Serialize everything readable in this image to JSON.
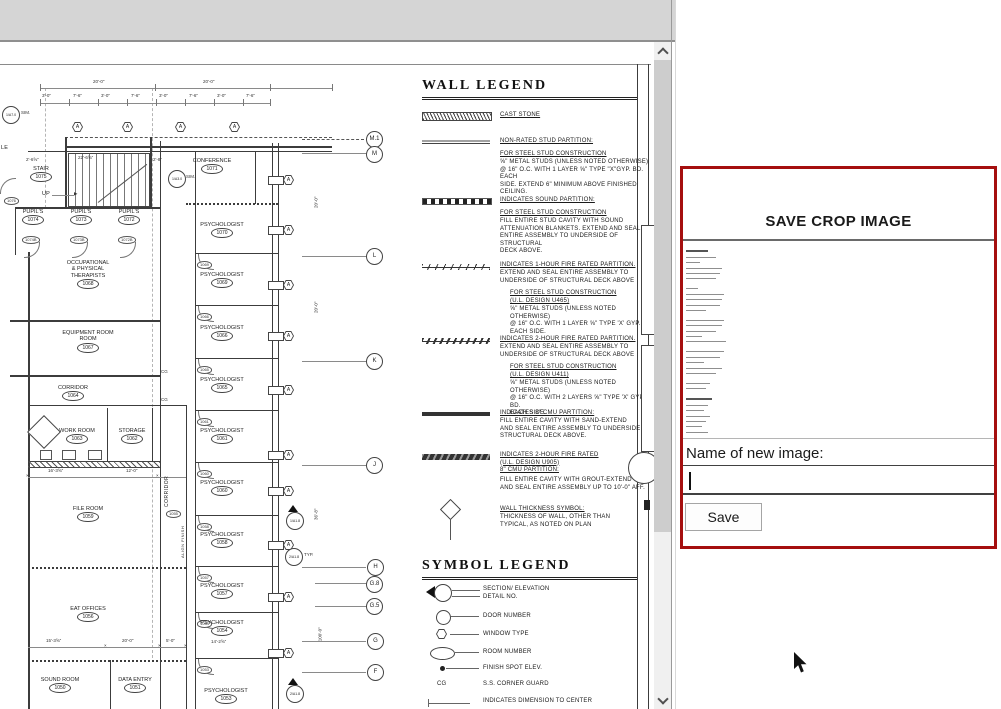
{
  "panel": {
    "title": "SAVE CROP IMAGE",
    "name_label": "Name of new image:",
    "input_value": "",
    "save_label": "Save"
  },
  "plan": {
    "window_tag": "A",
    "grid": [
      "M.1",
      "M",
      "L",
      "K",
      "J",
      "H",
      "G.8",
      "G.5",
      "G",
      "F"
    ],
    "rooms": [
      {
        "name": "STAIR",
        "num": "1075"
      },
      {
        "name": "CONFERENCE",
        "num": "1071"
      },
      {
        "name": "PUPIL'S",
        "num": "1074"
      },
      {
        "name": "PUPIL'S",
        "num": "1073"
      },
      {
        "name": "PUPIL'S",
        "num": "1072"
      },
      {
        "name": "PSYCHOLOGIST",
        "num": "1070"
      },
      {
        "name": "PSYCHOLOGIST",
        "num": "1069"
      },
      {
        "name": "OCCUPATIONAL\n& PHYSICAL\nTHERAPISTS",
        "num": "1068"
      },
      {
        "name": "EQUIPMENT ROOM\nROOM",
        "num": "1067"
      },
      {
        "name": "PSYCHOLOGIST",
        "num": "1066"
      },
      {
        "name": "CORRIDOR",
        "num": "1064"
      },
      {
        "name": "PSYCHOLOGIST",
        "num": "1065"
      },
      {
        "name": "WORK ROOM",
        "num": "1063"
      },
      {
        "name": "STORAGE",
        "num": "1062"
      },
      {
        "name": "PSYCHOLOGIST",
        "num": "1061"
      },
      {
        "name": "PSYCHOLOGIST",
        "num": "1060"
      },
      {
        "name": "FILE ROOM",
        "num": "1059"
      },
      {
        "name": "PSYCHOLOGIST",
        "num": "1058"
      },
      {
        "name": "PSYCHOLOGIST",
        "num": "1057"
      },
      {
        "name": "EAT OFFICES",
        "num": "1056"
      },
      {
        "name": "PSYCHOLOGIST",
        "num": "1054"
      },
      {
        "name": "SOUND ROOM",
        "num": "1050"
      },
      {
        "name": "DATA ENTRY",
        "num": "1051"
      },
      {
        "name": "PSYCHOLOGIST",
        "num": "1053"
      },
      {
        "name": "CORRIDOR",
        "num": "1055"
      }
    ],
    "door_tags": [
      "1069",
      "1066",
      "1065",
      "1061",
      "1060",
      "1058",
      "1057",
      "1054",
      "1053",
      "1074B",
      "1073B",
      "1072B",
      "1076"
    ],
    "labels": {
      "up": "UP",
      "sim": "SIM.",
      "typ": "TYP.",
      "align": "ALIGN FINISH",
      "cg": "CG",
      "le": "LE"
    },
    "markers": {
      "m1": "1/A7.0",
      "m2": "1/A3.0",
      "m3": "1/A1.8",
      "m4": "2/A1.8",
      "m5": "2/A1.8"
    },
    "dims": {
      "top": [
        "20'-0\"",
        "20'-0\""
      ],
      "small": [
        "3'-0\"",
        "7'-6\"",
        "3'-0\"",
        "7'-6\"",
        "3'-0\"",
        "7'-6\"",
        "3'-0\"",
        "7'-6\""
      ],
      "stair": [
        "2'-6⅝\"",
        "22'-6⅝\"",
        "2'-8\""
      ],
      "mid": [
        "16'-3⅝\"",
        "12'-0\""
      ],
      "low": [
        "15'-3⅝\"",
        "20'-0\"",
        "5'-0\""
      ],
      "right": [
        "20'-0\"",
        "20'-0\"",
        "36'-8\"",
        "100'-0\""
      ],
      "r1054": "14'-2⅝\""
    }
  },
  "wall_legend": {
    "title": "WALL LEGEND",
    "thickness_value": "6\"",
    "items": [
      {
        "heading": "CAST STONE"
      },
      {
        "heading": "NON-RATED STUD PARTITION:",
        "sub1": "FOR STEEL STUD CONSTRUCTION",
        "body": "⅝\" METAL STUDS (UNLESS NOTED OTHERWISE)\n@ 16\" O.C. WITH 1 LAYER ⅝\" TYPE \"X\"GYP. BD. EACH\nSIDE.  EXTEND 6\" MINIMUM ABOVE FINISHED CEILING."
      },
      {
        "heading": "INDICATES SOUND PARTITION:",
        "sub1": "FOR STEEL STUD CONSTRUCTION",
        "body": "FILL ENTIRE STUD CAVITY WITH SOUND\nATTENUATION BLANKETS.  EXTEND AND SEAL\nENTIRE ASSEMBLY TO UNDERSIDE OF STRUCTURAL\nDECK ABOVE."
      },
      {
        "heading": "INDICATES 1-HOUR FIRE RATED PARTITION.",
        "cont": "EXTEND AND SEAL ENTIRE ASSEMBLY TO\nUNDERSIDE OF STRUCTURAL DECK ABOVE",
        "sub1": "FOR STEEL STUD CONSTRUCTION",
        "sub2": "(U.L. DESIGN U465)",
        "body": "⅝\" METAL STUDS (UNLESS NOTED OTHERWISE)\n@ 16\" O.C. WITH 1 LAYER ⅝\" TYPE 'X' GYP. BD.\nEACH SIDE."
      },
      {
        "heading": "INDICATES 2-HOUR FIRE RATED PARTITION.",
        "cont": "EXTEND AND SEAL ENTIRE ASSEMBLY TO\nUNDERSIDE OF STRUCTURAL DECK ABOVE",
        "sub1": "FOR STEEL STUD CONSTRUCTION",
        "sub2": "(U.L. DESIGN U411)",
        "body": "⅝\" METAL STUDS (UNLESS NOTED OTHERWISE)\n@ 16\" O.C. WITH 2 LAYERS ⅝\" TYPE 'X' GYP. BD.\nEACH SIDE."
      },
      {
        "heading": "INDICATES 8\" CMU PARTITION:",
        "cont": "FILL ENTIRE CAVITY WITH SAND-EXTEND\nAND SEAL ENTIRE ASSEMBLY TO UNDERSIDE OF\nSTRUCTURAL DECK ABOVE."
      },
      {
        "heading": "INDICATES 2-HOUR FIRE RATED\n(U.L. DESIGN U905)\n8\" CMU PARTITION:",
        "cont": "FILL ENTIRE CAVITY WITH GROUT-EXTEND\nAND SEAL ENTIRE ASSEMBLY UP TO 10'-0\" AFF."
      },
      {
        "heading": "WALL THICKNESS SYMBOL:",
        "cont": "THICKNESS OF WALL, OTHER THAN\nTYPICAL, AS NOTED ON PLAN"
      }
    ]
  },
  "symbol_legend": {
    "title": "SYMBOL LEGEND",
    "items": [
      {
        "label": "SECTION/ ELEVATION\nDETAIL NO."
      },
      {
        "label": "DOOR NUMBER"
      },
      {
        "label": "WINDOW TYPE"
      },
      {
        "label": "ROOM NUMBER"
      },
      {
        "label": "FINISH SPOT ELEV."
      },
      {
        "label": "S.S. CORNER GUARD"
      },
      {
        "label": "INDICATES DIMENSION TO CENTER"
      }
    ]
  }
}
